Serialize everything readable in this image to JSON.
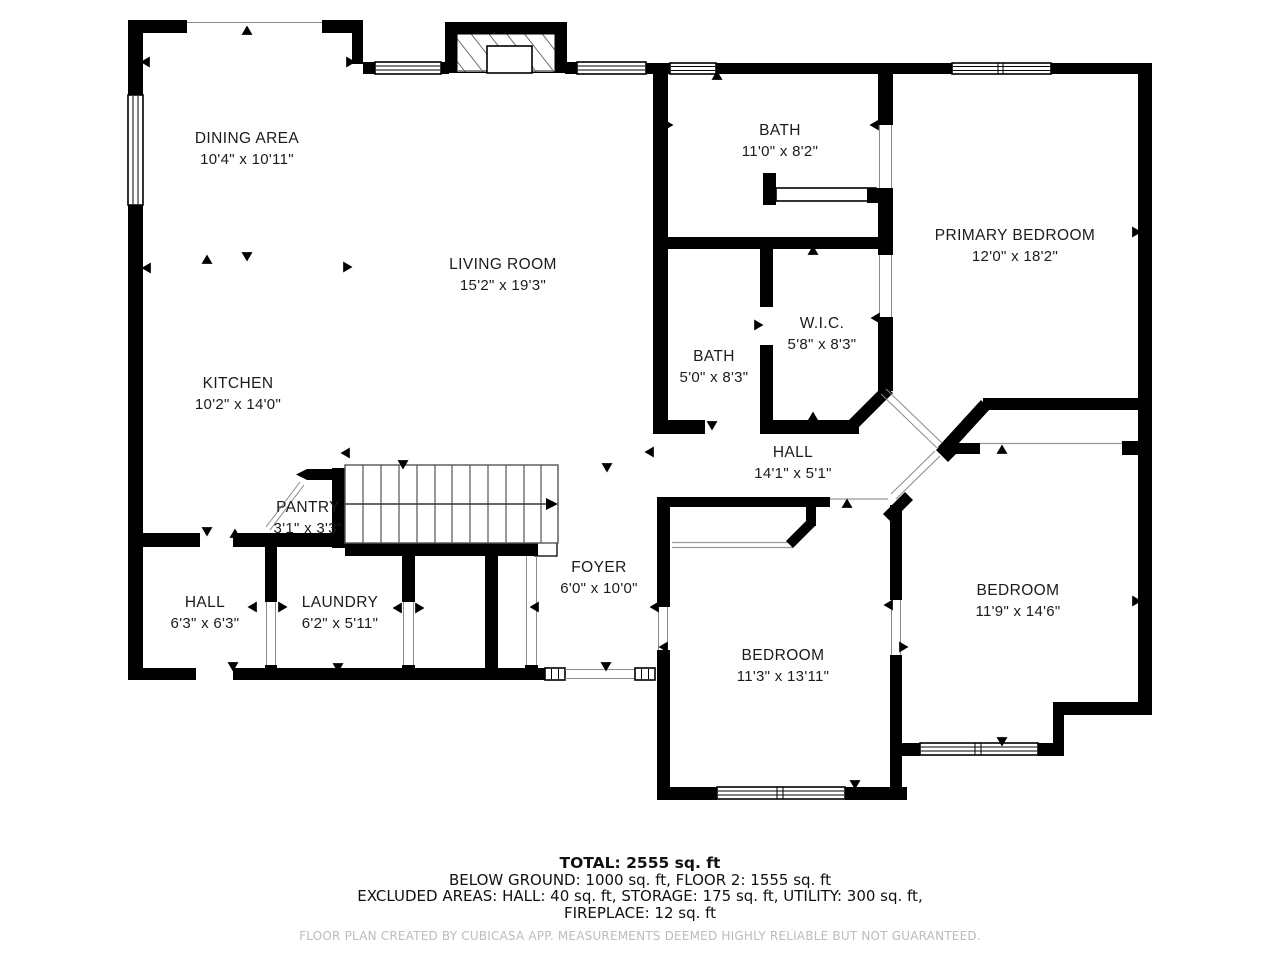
{
  "plan_title": "Floor plan",
  "rooms": [
    {
      "name": "DINING AREA",
      "dims": "10'4\" x 10'11\"",
      "x": 247,
      "y": 143
    },
    {
      "name": "LIVING ROOM",
      "dims": "15'2\" x 19'3\"",
      "x": 503,
      "y": 269
    },
    {
      "name": "KITCHEN",
      "dims": "10'2\" x 14'0\"",
      "x": 238,
      "y": 388
    },
    {
      "name": "BATH",
      "dims": "11'0\" x 8'2\"",
      "x": 780,
      "y": 135
    },
    {
      "name": "PRIMARY BEDROOM",
      "dims": "12'0\" x 18'2\"",
      "x": 1015,
      "y": 240
    },
    {
      "name": "W.I.C.",
      "dims": "5'8\" x 8'3\"",
      "x": 822,
      "y": 328
    },
    {
      "name": "BATH",
      "dims": "5'0\" x 8'3\"",
      "x": 714,
      "y": 361
    },
    {
      "name": "HALL",
      "dims": "14'1\" x 5'1\"",
      "x": 793,
      "y": 457
    },
    {
      "name": "PANTRY",
      "dims": "3'1\" x 3'3\"",
      "x": 308,
      "y": 512
    },
    {
      "name": "FOYER",
      "dims": "6'0\" x 10'0\"",
      "x": 599,
      "y": 572
    },
    {
      "name": "HALL",
      "dims": "6'3\" x 6'3\"",
      "x": 205,
      "y": 607
    },
    {
      "name": "LAUNDRY",
      "dims": "6'2\" x 5'11\"",
      "x": 340,
      "y": 607
    },
    {
      "name": "BEDROOM",
      "dims": "11'3\" x 13'11\"",
      "x": 783,
      "y": 660
    },
    {
      "name": "BEDROOM",
      "dims": "11'9\" x 14'6\"",
      "x": 1018,
      "y": 595
    }
  ],
  "summary": {
    "total": "TOTAL: 2555 sq. ft",
    "line2": "BELOW GROUND: 1000 sq. ft, FLOOR 2: 1555 sq. ft",
    "line3": "EXCLUDED AREAS: HALL: 40 sq. ft, STORAGE: 175 sq. ft, UTILITY: 300 sq. ft,",
    "line4": "FIREPLACE: 12 sq. ft"
  },
  "footer": "FLOOR PLAN CREATED BY CUBICASA APP. MEASUREMENTS DEEMED HIGHLY RELIABLE BUT NOT GUARANTEED."
}
